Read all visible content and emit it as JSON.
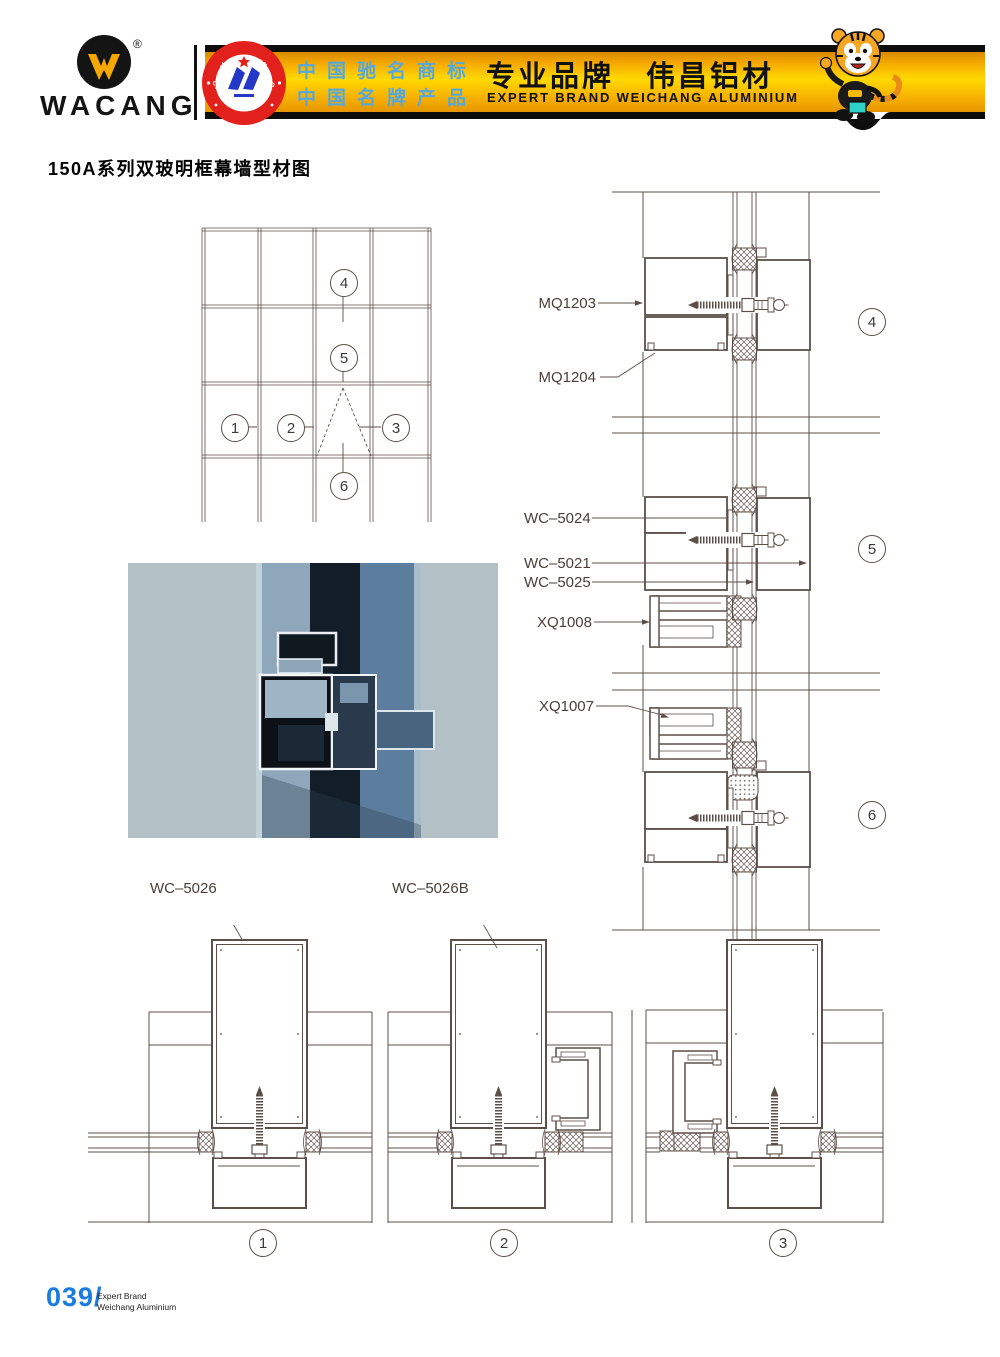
{
  "header": {
    "logo": {
      "text": "WACANG",
      "registered": "®"
    },
    "badge": {
      "arc_top": "中国名牌",
      "arc_bottom": "CHINA TOP BRAND"
    },
    "banner": {
      "cn_line1": "中国驰名商标",
      "cn_line2": "中国名牌产品",
      "brand_cn": "专业品牌　伟昌铝材",
      "brand_en": "EXPERT BRAND WEICHANG ALUMINIUM"
    }
  },
  "title": "150A系列双玻明框幕墙型材图",
  "elevation": {
    "c1": "1",
    "c2": "2",
    "c3": "3",
    "c4": "4",
    "c5": "5",
    "c6": "6"
  },
  "details": {
    "d4": {
      "num": "4",
      "label1": "MQ1203",
      "label2": "MQ1204"
    },
    "d5": {
      "num": "5",
      "label1": "WC–5024",
      "label2": "WC–5021",
      "label3": "WC–5025",
      "label4": "XQ1008"
    },
    "d6": {
      "num": "6",
      "label1": "XQ1007"
    }
  },
  "sections": {
    "s1": {
      "num": "1",
      "label": "WC–5026"
    },
    "s2": {
      "num": "2",
      "label": "WC–5026B"
    },
    "s3": {
      "num": "3"
    }
  },
  "footer": {
    "page": "039/",
    "line1": "Expert Brand",
    "line2": "Weichang Aluminium"
  },
  "colors": {
    "banner_gold": "#ffd200",
    "badge_red": "#e2211c",
    "banner_blue_text": "#56a8dc",
    "page_number_blue": "#1a7be0",
    "cad_line": "#5c4f49",
    "render_bg": "#b3c1c7"
  }
}
